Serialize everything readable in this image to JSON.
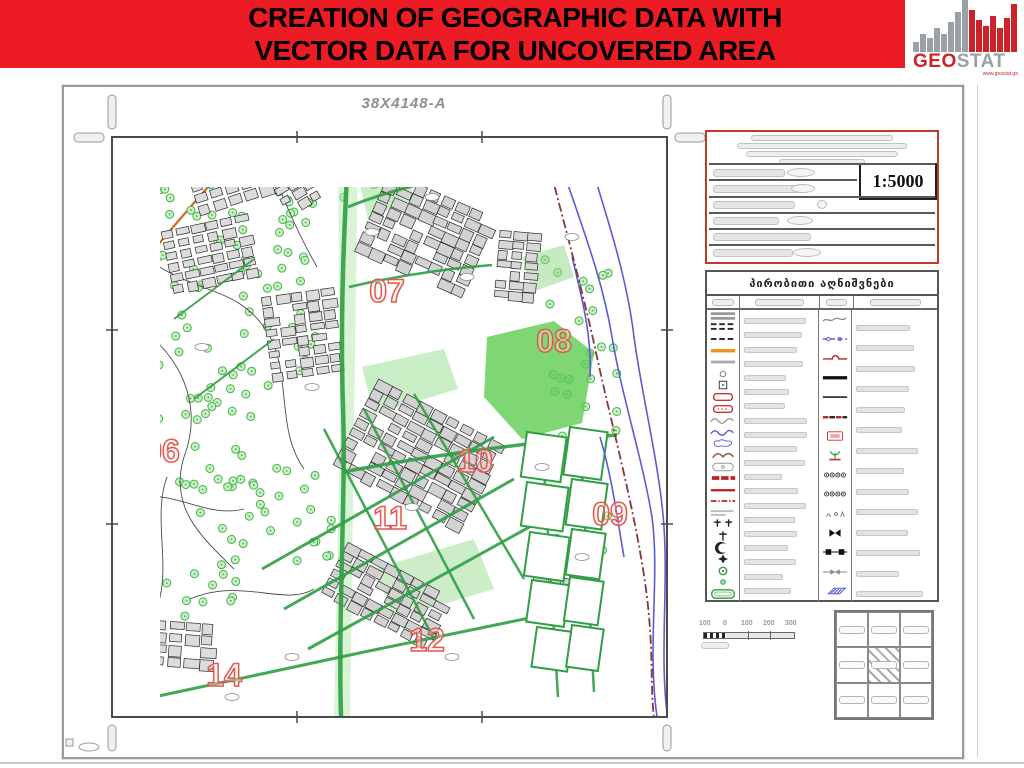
{
  "header": {
    "title_line1": "CREATION OF GEOGRAPHIC DATA WITH",
    "title_line2": "VECTOR DATA FOR UNCOVERED AREA",
    "bg_color": "#ec1b24"
  },
  "logo": {
    "geo": "GEO",
    "stat": "STAT",
    "url": "www.geostat.ge",
    "red": "#cc2229",
    "gray": "#9ba0a4",
    "bars_gray": [
      10,
      18,
      14,
      24,
      18,
      30,
      40,
      52
    ],
    "bars_red": [
      42,
      32,
      26,
      36,
      24,
      34,
      48
    ]
  },
  "map": {
    "sheet_label": "38X4148-A",
    "zone_color": "#e4574d",
    "zones": [
      {
        "label": "06",
        "x": 50,
        "y": 325
      },
      {
        "label": "07",
        "x": 275,
        "y": 165
      },
      {
        "label": "08",
        "x": 442,
        "y": 215
      },
      {
        "label": "09",
        "x": 498,
        "y": 388
      },
      {
        "label": "10",
        "x": 363,
        "y": 335
      },
      {
        "label": "11",
        "x": 278,
        "y": 392
      },
      {
        "label": "12",
        "x": 315,
        "y": 514
      },
      {
        "label": "14",
        "x": 112,
        "y": 549
      }
    ],
    "graphics": {
      "tree_clusters": [
        {
          "x0": 4,
          "y0": 4,
          "x1": 215,
          "y1": 255,
          "n": 95
        },
        {
          "x0": 4,
          "y0": 255,
          "x1": 140,
          "y1": 430,
          "n": 48
        },
        {
          "x0": 140,
          "y0": 330,
          "x1": 225,
          "y1": 425,
          "n": 20
        },
        {
          "x0": 430,
          "y0": 115,
          "x1": 505,
          "y1": 300,
          "n": 26
        },
        {
          "x0": 438,
          "y0": 300,
          "x1": 498,
          "y1": 420,
          "n": 14
        },
        {
          "x0": 150,
          "y0": 2,
          "x1": 285,
          "y1": 70,
          "n": 16
        },
        {
          "x0": 40,
          "y0": 430,
          "x1": 130,
          "y1": 480,
          "n": 10
        }
      ],
      "green_patches": [
        {
          "pts": "375,200 442,184 482,216 470,286 410,302 372,260",
          "f": "#5ecc52",
          "o": 0.8
        },
        {
          "pts": "226,0 246,0 242,290 238,580 222,580 228,290",
          "f": "#a8e6a0",
          "o": 0.45
        },
        {
          "pts": "250,230 332,212 346,252 262,277",
          "f": "#90dd8a",
          "o": 0.5
        },
        {
          "pts": "262,432 362,402 382,452 282,482",
          "f": "#8ed886",
          "o": 0.45
        },
        {
          "pts": "246,40 292,26 302,62 256,82",
          "f": "#90dd8a",
          "o": 0.5
        },
        {
          "pts": "410,120 452,108 462,140 420,155",
          "f": "#8ed886",
          "o": 0.5
        }
      ],
      "contours": [
        "M10,180 C60,205 95,260 72,320 C56,372 92,402 122,432",
        "M30,118 C82,158 122,148 152,190 C182,232 162,290 192,332",
        "M78,462 C130,440 172,470 202,452",
        "M18,362 C62,350 92,382 132,372",
        "M150,2 C165,50 185,95 205,130",
        "M55,340 C40,380 60,430 45,470"
      ],
      "orange_line": "M8,152 C45,110 85,60 122,22",
      "block_clusters": [
        {
          "x": 78,
          "y": 8,
          "cols": 6,
          "rows": 5,
          "cw": 13,
          "ch": 9,
          "gx": 3,
          "gy": 3,
          "rot": -18,
          "f": "#dcdcdc"
        },
        {
          "x": 55,
          "y": 85,
          "cols": 6,
          "rows": 6,
          "cw": 12,
          "ch": 8,
          "gx": 3,
          "gy": 3,
          "rot": -12,
          "f": "#dcdcdc"
        },
        {
          "x": 155,
          "y": 155,
          "cols": 5,
          "rows": 8,
          "cw": 12,
          "ch": 8,
          "gx": 3,
          "gy": 3,
          "rot": -8,
          "f": "#dcdcdc"
        },
        {
          "x": 255,
          "y": 55,
          "cols": 8,
          "rows": 8,
          "cw": 13,
          "ch": 9,
          "gx": 2,
          "gy": 2,
          "rot": 24,
          "f": "#d2d2d2"
        },
        {
          "x": 385,
          "y": 95,
          "cols": 3,
          "rows": 7,
          "cw": 12,
          "ch": 8,
          "gx": 2,
          "gy": 2,
          "rot": 5,
          "f": "#d8d8d8"
        },
        {
          "x": 235,
          "y": 270,
          "cols": 9,
          "rows": 9,
          "cw": 14,
          "ch": 9,
          "gx": 2,
          "gy": 2,
          "rot": 28,
          "f": "#d2d2d2"
        },
        {
          "x": 215,
          "y": 430,
          "cols": 8,
          "rows": 6,
          "cw": 13,
          "ch": 8,
          "gx": 2,
          "gy": 2,
          "rot": 28,
          "f": "#d2d2d2"
        },
        {
          "x": 25,
          "y": 485,
          "cols": 5,
          "rows": 4,
          "cw": 13,
          "ch": 9,
          "gx": 3,
          "gy": 3,
          "rot": 4,
          "f": "#dcdcdc"
        },
        {
          "x": 165,
          "y": 30,
          "cols": 3,
          "rows": 4,
          "cw": 11,
          "ch": 8,
          "gx": 3,
          "gy": 3,
          "rot": -30,
          "f": "#dcdcdc"
        },
        {
          "x": 420,
          "y": 430,
          "cols": 4,
          "rows": 4,
          "cw": 12,
          "ch": 8,
          "gx": 3,
          "gy": 3,
          "rot": 10,
          "f": "#d8d8d8"
        }
      ],
      "roads": [
        {
          "d": "M237,0 C232,90 228,180 231,270 C234,360 226,470 229,580",
          "w": 4.5
        },
        {
          "d": "M236,70 C290,48 350,38 420,22",
          "w": 3
        },
        {
          "d": "M231,335 C320,318 420,305 505,298",
          "w": 3.5
        },
        {
          "d": "M150,432 L382,300",
          "w": 3
        },
        {
          "d": "M172,472 L402,342",
          "w": 3
        },
        {
          "d": "M196,512 L432,382",
          "w": 3
        },
        {
          "d": "M252,272 L362,482",
          "w": 2.5
        },
        {
          "d": "M302,257 L412,442",
          "w": 2.5
        },
        {
          "d": "M212,292 L322,502",
          "w": 2.5
        },
        {
          "d": "M42,560 L252,515 L432,478",
          "w": 3
        },
        {
          "d": "M430,300 L446,560",
          "w": 2.5
        },
        {
          "d": "M468,296 L482,555",
          "w": 2.5
        },
        {
          "d": "M62,182 L142,122",
          "w": 2
        },
        {
          "d": "M82,262 L162,202",
          "w": 2
        },
        {
          "d": "M237,150 C280,140 330,132 380,128",
          "w": 2.5
        }
      ],
      "parcels": [
        [
          415,
          295,
          40,
          45
        ],
        [
          458,
          290,
          38,
          48
        ],
        [
          415,
          345,
          42,
          44
        ],
        [
          460,
          342,
          36,
          46
        ],
        [
          418,
          395,
          40,
          44
        ],
        [
          460,
          392,
          34,
          46
        ],
        [
          420,
          443,
          38,
          42
        ],
        [
          458,
          440,
          34,
          44
        ],
        [
          425,
          490,
          36,
          40
        ],
        [
          460,
          488,
          32,
          42
        ]
      ],
      "river_paths": [
        "M450,30 C470,90 490,140 500,200 C510,260 530,320 540,380 C548,440 535,510 545,580",
        "M475,15 C495,80 515,140 522,200 C530,260 548,330 552,390 C556,450 548,520 555,575",
        "M460,120 C470,160 480,200 478,240",
        "M488,300 C500,340 505,380 512,420"
      ],
      "boundary_path": "M430,0 C450,80 470,150 485,220 C500,290 525,380 535,460 C542,520 538,550 542,580",
      "ellipse_labels": [
        [
          260,
          95
        ],
        [
          320,
          60
        ],
        [
          355,
          140
        ],
        [
          200,
          250
        ],
        [
          300,
          370
        ],
        [
          180,
          520
        ],
        [
          340,
          520
        ],
        [
          430,
          330
        ],
        [
          470,
          420
        ],
        [
          120,
          560
        ],
        [
          90,
          210
        ],
        [
          460,
          100
        ]
      ]
    }
  },
  "title_block": {
    "scale": "1:5000",
    "border_color": "#c0392b"
  },
  "legend": {
    "header": "პირობითი აღნიშვნები",
    "col1_symbols": [
      "bars2",
      "dashes2",
      "dashes",
      "bar-orange",
      "bar-gray",
      "circle-sm",
      "square-dot",
      "rrect-red",
      "rrect-red2",
      "scurve-gray",
      "scurve-blue",
      "blob-blue",
      "arcs-brown",
      "blob-gray",
      "dashes-red",
      "bar-red",
      "dashdot-red",
      "text-sm",
      "cross2",
      "cross",
      "crescent",
      "star",
      "circle-dot",
      "dot-green",
      "rrect-green"
    ],
    "col2_blob_count": 22,
    "col3_symbols": [
      "wave-gray",
      "blue-dash",
      "red-bump",
      "bar-black",
      "line-black",
      "dash-redblack",
      "box-red",
      "plant",
      "circles4",
      "circles4",
      "glyphs",
      "bowtie-black",
      "squares-link",
      "bowtie-gray",
      "para-blue"
    ],
    "col4_blob_count": 14
  },
  "scale_bar": {
    "labels": [
      "100",
      "0",
      "100",
      "200",
      "300"
    ]
  },
  "index_grid": {
    "rows": 3,
    "cols": 3,
    "highlighted_row": 1,
    "highlighted_col": 1
  }
}
